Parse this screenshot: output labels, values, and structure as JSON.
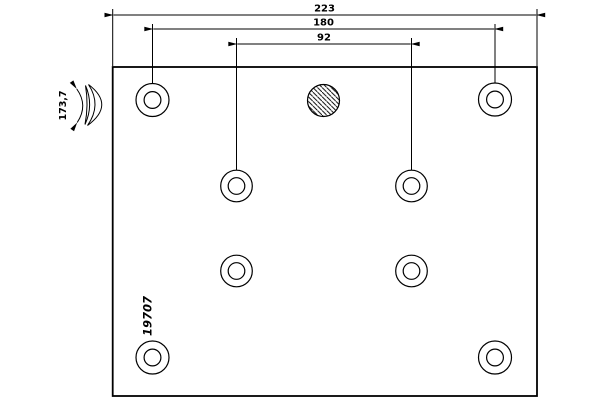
{
  "drawing": {
    "title": "Brake lining technical drawing",
    "part_number": "19707",
    "colors": {
      "line": "#000000",
      "background": "#ffffff"
    },
    "dimensions": {
      "overall_length": "223",
      "outer_hole_spacing": "180",
      "inner_hole_spacing": "92",
      "arc_width": "173,7"
    },
    "features": {
      "mounting_hole_count": 8,
      "hatched_hole_count": 1,
      "hole_pattern": "4 counterbored corner holes and 4 counterbored inner holes in two columns",
      "side_view": "curved cross-section symbol with arc-width dimension at left"
    }
  }
}
